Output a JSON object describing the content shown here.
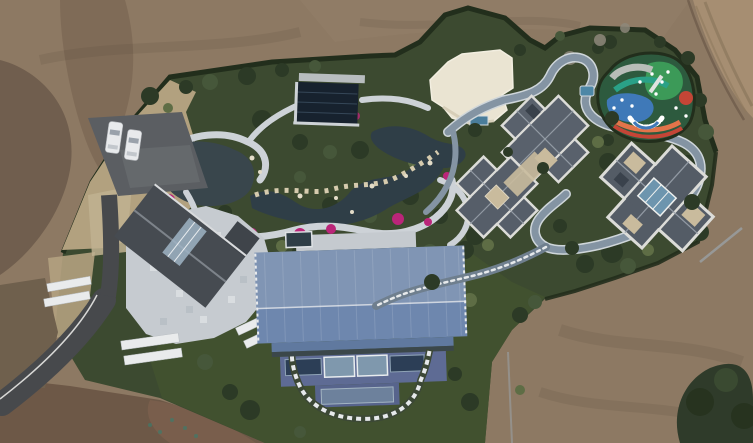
{
  "meta": {
    "type": "aerial-drone-photograph",
    "subject": "Top-down aerial view of a landscaped private estate compound with ornamental gardens, ponds, several houses and a large blue-roofed barn, surrounded by bare graded earth",
    "vehicle_count": 2
  },
  "scene": {
    "regions": [
      "bare-earth-field",
      "dirt-road",
      "boundary-hedge",
      "ornamental-garden",
      "pond",
      "rock-stream",
      "flower-beds",
      "stone-paths",
      "parking-lot",
      "driveway",
      "stone-terrace",
      "left-house",
      "glass-pavilion",
      "white-flat-roof-building",
      "plunge-pool",
      "gray-roof-house-1",
      "gray-roof-house-2",
      "gray-roof-house-3",
      "children-playground",
      "loop-path",
      "stepped-walkway",
      "blue-metal-barn",
      "lawn",
      "tree-grove"
    ]
  },
  "palette": {
    "dirt": "#8d7963",
    "dirt_dark": "#6b594a",
    "dirt_warm": "#94806a",
    "dirt_band": "#74604e",
    "dirt_bottom": "#6d5847",
    "dirt_red": "#7a5f4c",
    "road_tan": "#a68e72",
    "hedge": "#222e1c",
    "green": "#3c4a30",
    "lawn": "#41512f",
    "dry_grass": "#b2a17f",
    "dry_grass2": "#c0b190",
    "scrub": "#6f604d",
    "tree_dark": "#2c3a26",
    "tree_mid": "#46573a",
    "tree_light": "#5e6d45",
    "grove": "#2f3b2a",
    "bare_tree": "#8e887b",
    "asphalt": "#5b5e62",
    "driveway": "#47494c",
    "road_line": "#d8d8d6",
    "car": "#e8eaec",
    "stone_path": "#cdd2d7",
    "terrace": "#c6cbd0",
    "bench": "#e9ebec",
    "pond": "#39464c",
    "stream": "#2f3e47",
    "flower": "#bb2579",
    "rock": "#d6cbae",
    "rock_dot": "#e3dcc8",
    "pavilion": "#17222e",
    "deck": "#c5cacf",
    "cream": "#eae4d2",
    "pool": "#4a7d9b",
    "slate": "#59616c",
    "slate2": "#565e69",
    "slate3": "#545c66",
    "slate_ridge": "#98a0aa",
    "parapet": "#dcdcd8",
    "courtyard": "#c9bb9d",
    "skylight": "#6d95ae",
    "left_roof": "#464b51",
    "roof_glass": "#9fb4c4",
    "barn_upper": "#8095b4",
    "barn_lower": "#6e87ae",
    "barn_skirt": "#60799f",
    "barn_ridge": "#d9dee6",
    "facade": "#5e6b94",
    "facade2": "#57648c",
    "window_dark": "#2c3e56",
    "window_glass": "#7f98ad",
    "loop_road": "#8494a3",
    "road_edge": "#cfd6da",
    "step_walk": "#6f7f8e",
    "step_dash": "#e6e9eb",
    "wall": "#9aa0a4",
    "pg_base": "#2d5a3e",
    "pg_green": "#3c9a58",
    "pg_blue": "#3f79b8",
    "pg_teal": "#2aa187",
    "pg_orange": "#e2744a",
    "pg_red": "#c44536",
    "pg_light": "#b8bdb8",
    "white": "#ffffff"
  }
}
